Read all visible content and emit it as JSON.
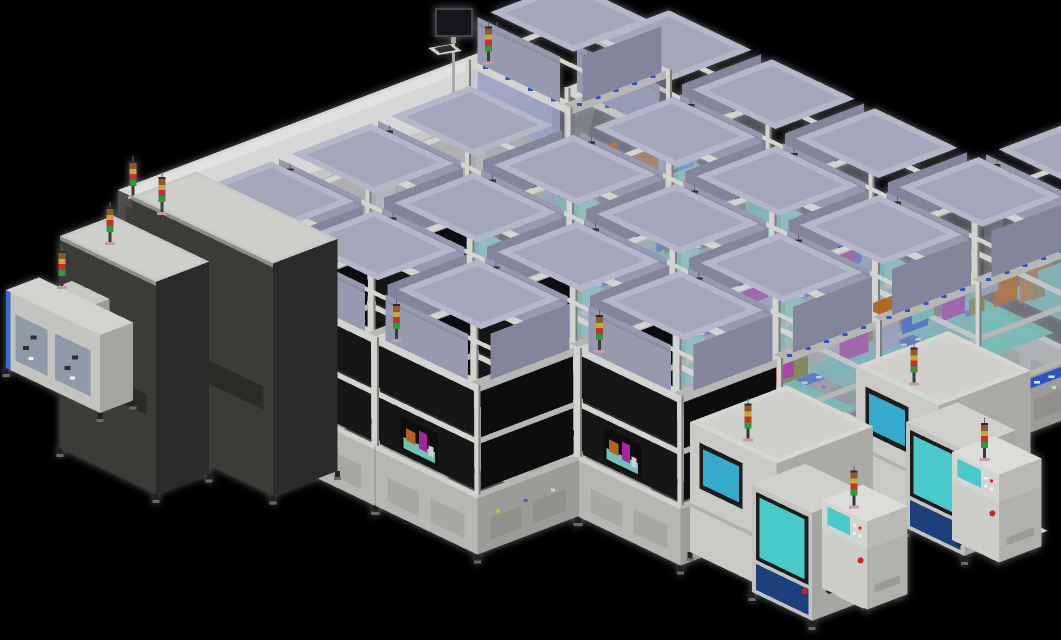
{
  "meta": {
    "title": "3d-factory-production-line-render",
    "width": 1061,
    "height": 640,
    "background": "#000000"
  },
  "colors": {
    "bg": "#000000",
    "frame_light": "#d3d3cf",
    "frame_mid": "#b6b6b2",
    "frame_dark": "#8e8e8a",
    "post_shadow": "#7e7e7a",
    "panel_dark": "#171717",
    "panel_dark2": "#0d0d0d",
    "base_left": "#b6b6b2",
    "base_right": "#9b9b97",
    "base_trim": "#cfcfcb",
    "base_inset": "#a7a7a3",
    "machine_top": "#b4b6ca",
    "machine_left": "#9799af",
    "machine_right": "#83859b",
    "machine_inset": "#a4a6ba",
    "glass": "rgba(155,165,185,0.30)",
    "glass_hi": "rgba(235,242,250,0.14)",
    "tunnel_top": "#d7d7d5",
    "tunnel_side": "#afafab",
    "tunnel_cap": "#4e4e4c",
    "tunnel_under": "#262624",
    "cab_top": "#c8c8c4",
    "cab_left": "#3b3b39",
    "cab_right": "#2c2c2a",
    "conveyor_blue": "#2a55c8",
    "deck_teal": "#6cc4b4",
    "tower_pole": "#3a3a3a",
    "tower_base": "#c59aac",
    "tower_segments": [
      "#2f9a38",
      "#c23232",
      "#c8a832",
      "#8d5a2a"
    ],
    "screen_cyan": "#35aacd",
    "station_cyan": "#49c9c9",
    "screen_frame": "#1b1b1b",
    "navy": "#1d3f7c",
    "monitor_dark": "#17191b",
    "monitor_frame": "#43474b",
    "silver": "#a8aaa8",
    "mint_top": "#bfe2c3",
    "mint_left": "#9cc9a5",
    "mint_right": "#86b890",
    "tray": "#cfd1cd",
    "keys": "#2e2e2c",
    "estop": "#cc2222",
    "estop_ring": "#e8c23a",
    "pale_screen": "#d2eede",
    "pale_frame": "#8fae9e",
    "loader_panel": "#8e9aa8",
    "loader_blue": "#3a6ad4",
    "loader_green": "#8fd89a",
    "white": "#ffffff",
    "innards": [
      "#a822a2",
      "#b3641e",
      "#3a62cc",
      "#6cc4b4",
      "#7a7a30",
      "#9aa0c4"
    ]
  },
  "iso": {
    "ux": 0.92,
    "uy": -0.35,
    "vx": 0.94,
    "vy": 0.45
  },
  "module": {
    "A": 108,
    "B": 108,
    "base_h": 62,
    "frame_h": 108,
    "box_h": 46,
    "tall_extra": 66,
    "post_w": 6
  },
  "lines": [
    {
      "name": "process-line-1",
      "origin": [
        170,
        408
      ],
      "modules": [
        "dark",
        "dark",
        "glass",
        "glass_tall",
        "glass"
      ]
    },
    {
      "name": "process-line-2",
      "origin": [
        273,
        457
      ],
      "modules": [
        "dark",
        "dark",
        "glass",
        "glass",
        "glass"
      ]
    },
    {
      "name": "process-line-3",
      "origin": [
        376,
        506
      ],
      "modules": [
        "dark",
        "dark",
        "glass",
        "glass",
        "glass"
      ]
    },
    {
      "name": "process-line-4",
      "origin": [
        579,
        517
      ],
      "modules": [
        "dark",
        "glass",
        "glass",
        "glass",
        "glass",
        "glass"
      ]
    }
  ],
  "tunnel": {
    "origin": [
      118,
      318
    ],
    "A": 400,
    "B": 70,
    "H": 128,
    "towers": [
      [
        133,
        198
      ],
      [
        497,
        64
      ]
    ]
  },
  "monitor": {
    "screen": [
      437,
      10,
      34,
      25
    ],
    "arm": [
      451,
      35,
      5,
      8
    ],
    "pole": [
      452,
      42,
      3,
      58
    ],
    "tray_quad": [
      [
        428,
        48
      ],
      [
        452,
        44
      ],
      [
        462,
        51
      ],
      [
        438,
        55
      ]
    ],
    "keys_quad": [
      [
        434,
        48
      ],
      [
        450,
        45
      ],
      [
        456,
        50
      ],
      [
        440,
        53
      ]
    ]
  },
  "cabinets": [
    {
      "name": "electrical-cabinet-rear",
      "origin": [
        132,
        428
      ],
      "A": 70,
      "B": 150,
      "H": 232,
      "tower": [
        162,
        214
      ]
    },
    {
      "name": "electrical-cabinet-front",
      "origin": [
        60,
        448
      ],
      "A": 58,
      "B": 102,
      "H": 212,
      "tower": [
        110,
        244
      ]
    }
  ],
  "loader": {
    "main": {
      "origin": [
        6,
        368
      ],
      "A": 36,
      "B": 100,
      "H": 78
    },
    "cabinet": {
      "origin": [
        48,
        352
      ],
      "A": 26,
      "B": 40,
      "H": 62
    },
    "tower": [
      62,
      288
    ]
  },
  "clusters": [
    {
      "name": "inspection-cell-right",
      "machine": {
        "origin": [
          856,
          492
        ],
        "A": 100,
        "B": 88,
        "H": 126
      },
      "station": {
        "origin": [
          906,
          528
        ],
        "A": 56,
        "B": 62,
        "H": 106
      },
      "console": {
        "origin": [
          952,
          540
        ],
        "A": 46,
        "B": 50,
        "H": 60
      }
    },
    {
      "name": "inspection-cell-left",
      "machine": {
        "origin": [
          690,
          552
        ],
        "A": 105,
        "B": 92,
        "H": 130
      },
      "station": {
        "origin": [
          752,
          592
        ],
        "A": 58,
        "B": 64,
        "H": 108
      },
      "console": {
        "origin": [
          822,
          588
        ],
        "A": 44,
        "B": 48,
        "H": 60
      },
      "crate": {
        "origin": [
          815,
          452
        ],
        "A": 26,
        "B": 30,
        "H": 22
      },
      "table": {
        "origin": [
          798,
          476
        ],
        "A": 28,
        "B": 44,
        "H": 34
      }
    }
  ]
}
